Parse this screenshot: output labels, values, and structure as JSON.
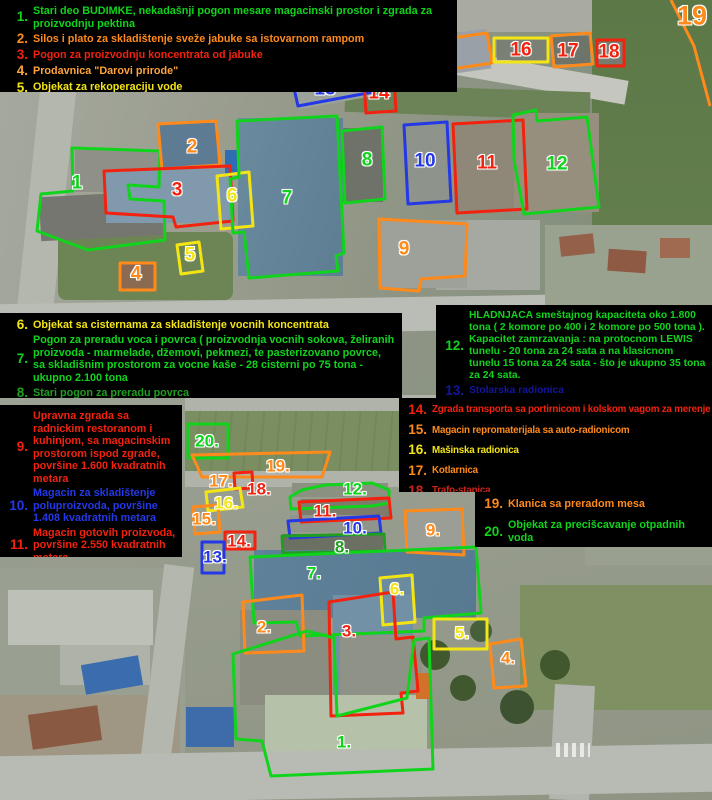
{
  "palette": {
    "green": "#10d41c",
    "dgreen": "#1f9e1f",
    "orange": "#ff8a1c",
    "amber": "#ffa43c",
    "red": "#f2220e",
    "dred": "#cc2418",
    "yellow": "#f3e414",
    "blue": "#2438e6",
    "dblue": "#15159c",
    "legend_background": "#000000"
  },
  "legends": {
    "b1": [
      {
        "num": "1.",
        "text": "Stari deo BUDIMKE, nekadašnji pogon mesare magacinski prostor i zgrada za proizvodnju pektina"
      },
      {
        "num": "2.",
        "text": "Silos i plato za skladištenje sveže jabuke sa istovarnom rampom"
      },
      {
        "num": "3.",
        "text": "Pogon za proizvodnju koncentrata od jabuke"
      },
      {
        "num": "4.",
        "text": "Prodavnica \"Darovi prirode\""
      },
      {
        "num": "5.",
        "text": "Objekat za rekoperaciju vode"
      }
    ],
    "b2": [
      {
        "num": "6.",
        "text": "Objekat sa cisternama za skladištenje vocnih koncentrata"
      },
      {
        "num": "7.",
        "text": "Pogon za preradu voca i povrca ( proizvodnja vocnih sokova, želiranih proizvoda - marmelade, džemovi, pekmezi, te pasterizovano povrce, sa skladišnim prostorom za vocne kaše - 28 cisterni po 75 tona - ukupno 2.100 tona"
      },
      {
        "num": "8.",
        "text": "Stari pogon za preradu povrca"
      }
    ],
    "b3": [
      {
        "num": "9.",
        "text": "Upravna zgrada sa radnickim restoranom i kuhinjom, sa magacinskim prostorom ispod zgrade, površine 1.600 kvadratnih metara"
      },
      {
        "num": "10.",
        "text": "Magacin za skladištenje poluproizvoda, površine 1.408 kvadratnih metara"
      },
      {
        "num": "11.",
        "text": "Magacin gotovih proizvoda, površine 2.550 kvadratnih metara"
      }
    ],
    "b4": [
      {
        "num": "12.",
        "text": "HLADNJACA smeštajnog kapaciteta oko 1.800 tona ( 2 komore po 400 i 2 komore po 500 tona ). Kapacitet zamrzavanja : na protocnom LEWIS tunelu - 20 tona za 24 sata a na klasicnom tunelu 15 tona za 24 sata - što je ukupno 35 tona za 24 sata."
      },
      {
        "num": "13.",
        "text": "Stolarska radionica"
      }
    ],
    "b5": [
      {
        "num": "14.",
        "text": "Zgrada transporta sa portirnicom i kolskom vagom za merenje"
      },
      {
        "num": "15.",
        "text": "Magacin repromaterijala sa auto-radionicom"
      },
      {
        "num": "16.",
        "text": "Mašinska radionica"
      },
      {
        "num": "17.",
        "text": "Kotlarnica"
      },
      {
        "num": "18.",
        "text": "Trafo-stanica"
      }
    ],
    "b6": [
      {
        "num": "19.",
        "text": "Klanica sa preradom mesa"
      },
      {
        "num": "20.",
        "text": "Objekat za precišcavanje otpadnih voda"
      }
    ]
  },
  "map": {
    "top": [
      "1",
      "2",
      "3",
      "4",
      "5",
      "6",
      "7",
      "8",
      "9",
      "10",
      "11",
      "12",
      "13",
      "14",
      "15",
      "16",
      "17",
      "18",
      "19"
    ],
    "bottom": [
      "1.",
      "2.",
      "3.",
      "4.",
      "5.",
      "6.",
      "7.",
      "8.",
      "9.",
      "10.",
      "11.",
      "12.",
      "13.",
      "14.",
      "15.",
      "16.",
      "17.",
      "18.",
      "19.",
      "20."
    ]
  }
}
